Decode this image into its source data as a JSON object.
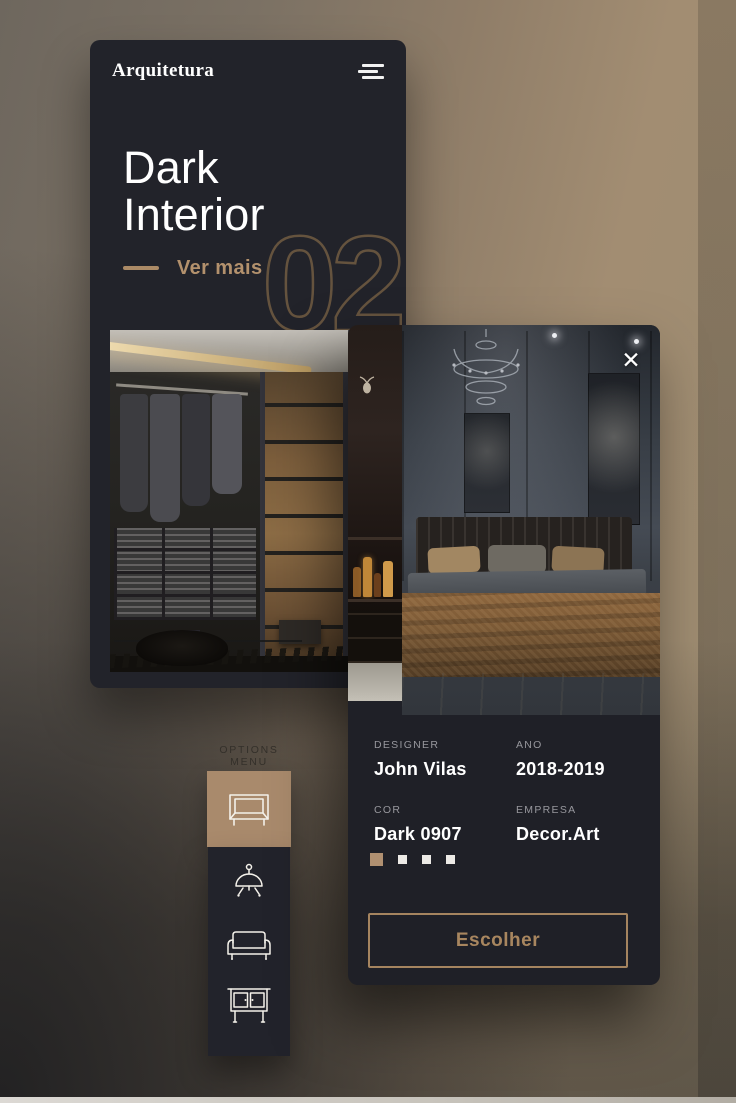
{
  "colors": {
    "accent_tan": "#b08f6f",
    "outline_number": "#6d5941",
    "selected_tile": "#a98a6c",
    "card_dark": "#22232a"
  },
  "home_screen": {
    "app_title": "Arquitetura",
    "menu_icon": "hamburger-menu-icon",
    "hero_title": "Dark Interior",
    "cta_label": "Ver mais",
    "slide_number": "02"
  },
  "detail_screen": {
    "close_label": "✕",
    "fields": [
      {
        "label": "DESIGNER",
        "value": "John Vilas"
      },
      {
        "label": "ANO",
        "value": "2018-2019"
      },
      {
        "label": "COR",
        "value": "Dark 0907"
      },
      {
        "label": "EMPRESA",
        "value": "Decor.Art"
      }
    ],
    "pagination": {
      "count": 4,
      "active_index": 0
    },
    "button_label": "Escolher"
  },
  "options_menu": {
    "label": "OPTIONS MENU",
    "items": [
      {
        "id": "bed-frame",
        "icon": "bed-frame-icon",
        "selected": true
      },
      {
        "id": "lamp",
        "icon": "lamp-icon",
        "selected": false
      },
      {
        "id": "sofa",
        "icon": "sofa-icon",
        "selected": false
      },
      {
        "id": "cabinet",
        "icon": "cabinet-icon",
        "selected": false
      }
    ]
  }
}
